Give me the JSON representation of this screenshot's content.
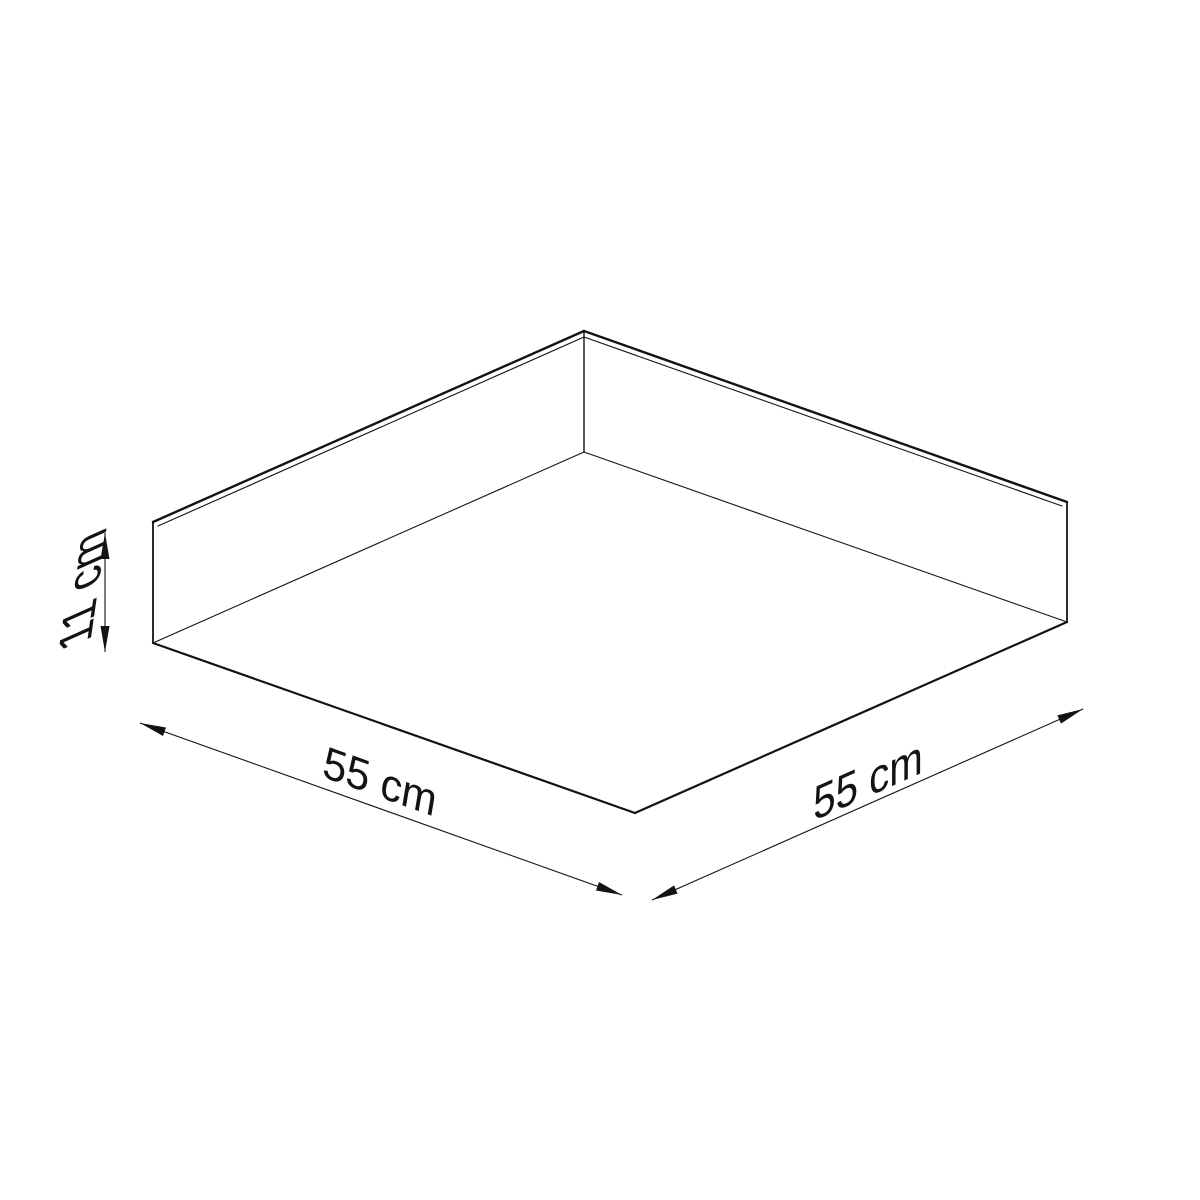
{
  "page": {
    "background_color": "#ffffff",
    "line_color": "#131313"
  },
  "drawing": {
    "kind": "product-dimension-drawing",
    "subject": "square ceiling lamp (plafond) shown from below in three-quarter view",
    "labels": {
      "width_left": "55 cm",
      "width_right": "55 cm",
      "height": "11 cm"
    },
    "values": {
      "width_left": {
        "value": 55,
        "unit": "cm"
      },
      "width_right": {
        "value": 55,
        "unit": "cm"
      },
      "height": {
        "value": 11,
        "unit": "cm"
      }
    }
  }
}
